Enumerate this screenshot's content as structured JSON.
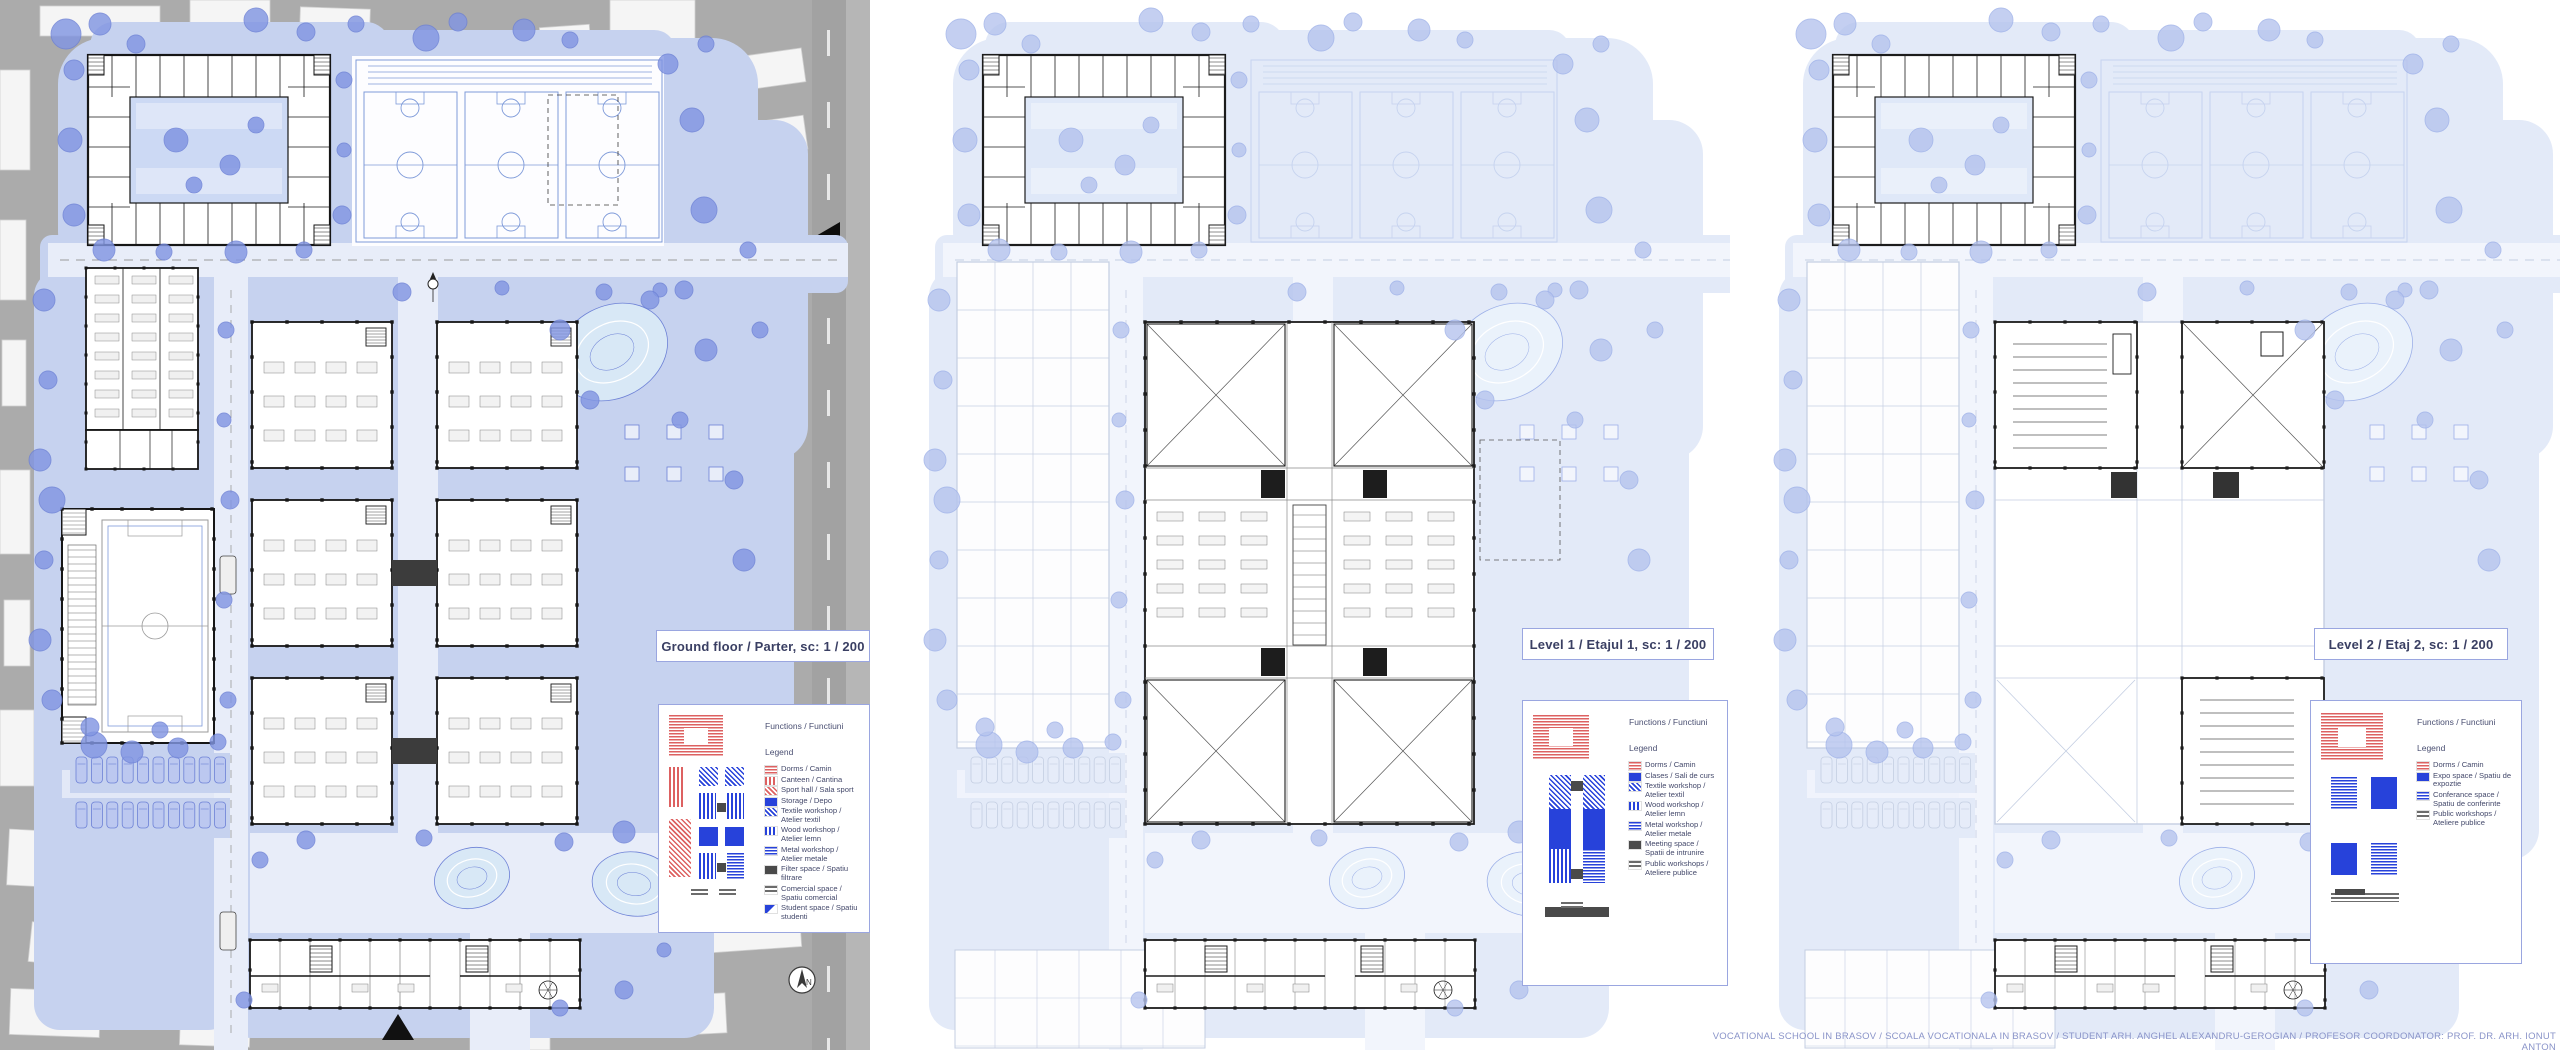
{
  "credit": "VOCATIONAL SCHOOL IN BRASOV  / SCOALA VOCATIONALA IN BRASOV / STUDENT ARH. ANGHEL ALEXANDRU-GEROGIAN / PROFESOR   COORDONATOR: PROF. DR. ARH. IONUT ANTON",
  "north_label": "N",
  "colors": {
    "legend_red": "#dd6161",
    "legend_blue": "#2742da",
    "legend_gray": "#6c6c6c",
    "legend_dark": "#4a4a4a",
    "box_border": "#9aa6e0",
    "box_text": "#3a3f63",
    "credit_text": "#8a94c9",
    "site_gray": "#ababab",
    "landscape_blue": "#c6d2ef",
    "tree_blue": "#8296e2"
  },
  "panels": [
    {
      "id": "ground",
      "title": "Ground floor / Parter, sc: 1 / 200",
      "functions_label": "Functions / Functiuni",
      "legend_label": "Legend",
      "legend": [
        {
          "label": "Dorms /  Camin",
          "swatch": "red-hstripes"
        },
        {
          "label": "Canteen / Cantina",
          "swatch": "red-vstripes"
        },
        {
          "label": "Sport hall / Sala sport",
          "swatch": "red-diag"
        },
        {
          "label": "Storage / Depo",
          "swatch": "blue-solid"
        },
        {
          "label": "Textile workshop / Atelier textil",
          "swatch": "blue-diag"
        },
        {
          "label": "Wood workshop / Atelier lemn",
          "swatch": "blue-vstripes"
        },
        {
          "label": "Metal workshop / Atelier metale",
          "swatch": "blue-hstripes"
        },
        {
          "label": "Filter space / Spatiu filtrare",
          "swatch": "darkgray-solid"
        },
        {
          "label": "Comercial space / Spatiu comercial",
          "swatch": "gray-hstripes"
        },
        {
          "label": "Student space / Spatiu studenti",
          "swatch": "blue-half"
        }
      ]
    },
    {
      "id": "level1",
      "title": "Level 1 / Etajul 1, sc: 1 / 200",
      "functions_label": "Functions / Functiuni",
      "legend_label": "Legend",
      "legend": [
        {
          "label": "Dorms /  Camin",
          "swatch": "red-hstripes"
        },
        {
          "label": "Clases / Sali de curs",
          "swatch": "blue-solid"
        },
        {
          "label": "Textile workshop / Atelier textil",
          "swatch": "blue-diag"
        },
        {
          "label": "Wood workshop / Atelier lemn",
          "swatch": "blue-vstripes"
        },
        {
          "label": "Metal workshop / Atelier metale",
          "swatch": "blue-hstripes"
        },
        {
          "label": "Meeting space / Spatii de intrunire",
          "swatch": "darkgray-solid"
        },
        {
          "label": "Public workshops / Ateliere publice",
          "swatch": "gray-hstripes"
        }
      ]
    },
    {
      "id": "level2",
      "title": "Level 2 / Etaj 2, sc: 1 / 200",
      "functions_label": "Functions / Functiuni",
      "legend_label": "Legend",
      "legend": [
        {
          "label": "Dorms /  Camin",
          "swatch": "red-hstripes"
        },
        {
          "label": "Expo space / Spatiu de expoztie",
          "swatch": "blue-solid"
        },
        {
          "label": "Conferance space / Spatiu de conferinte",
          "swatch": "blue-hstripes"
        },
        {
          "label": "Public workshops / Ateliere publice",
          "swatch": "gray-hstripes"
        }
      ]
    }
  ]
}
